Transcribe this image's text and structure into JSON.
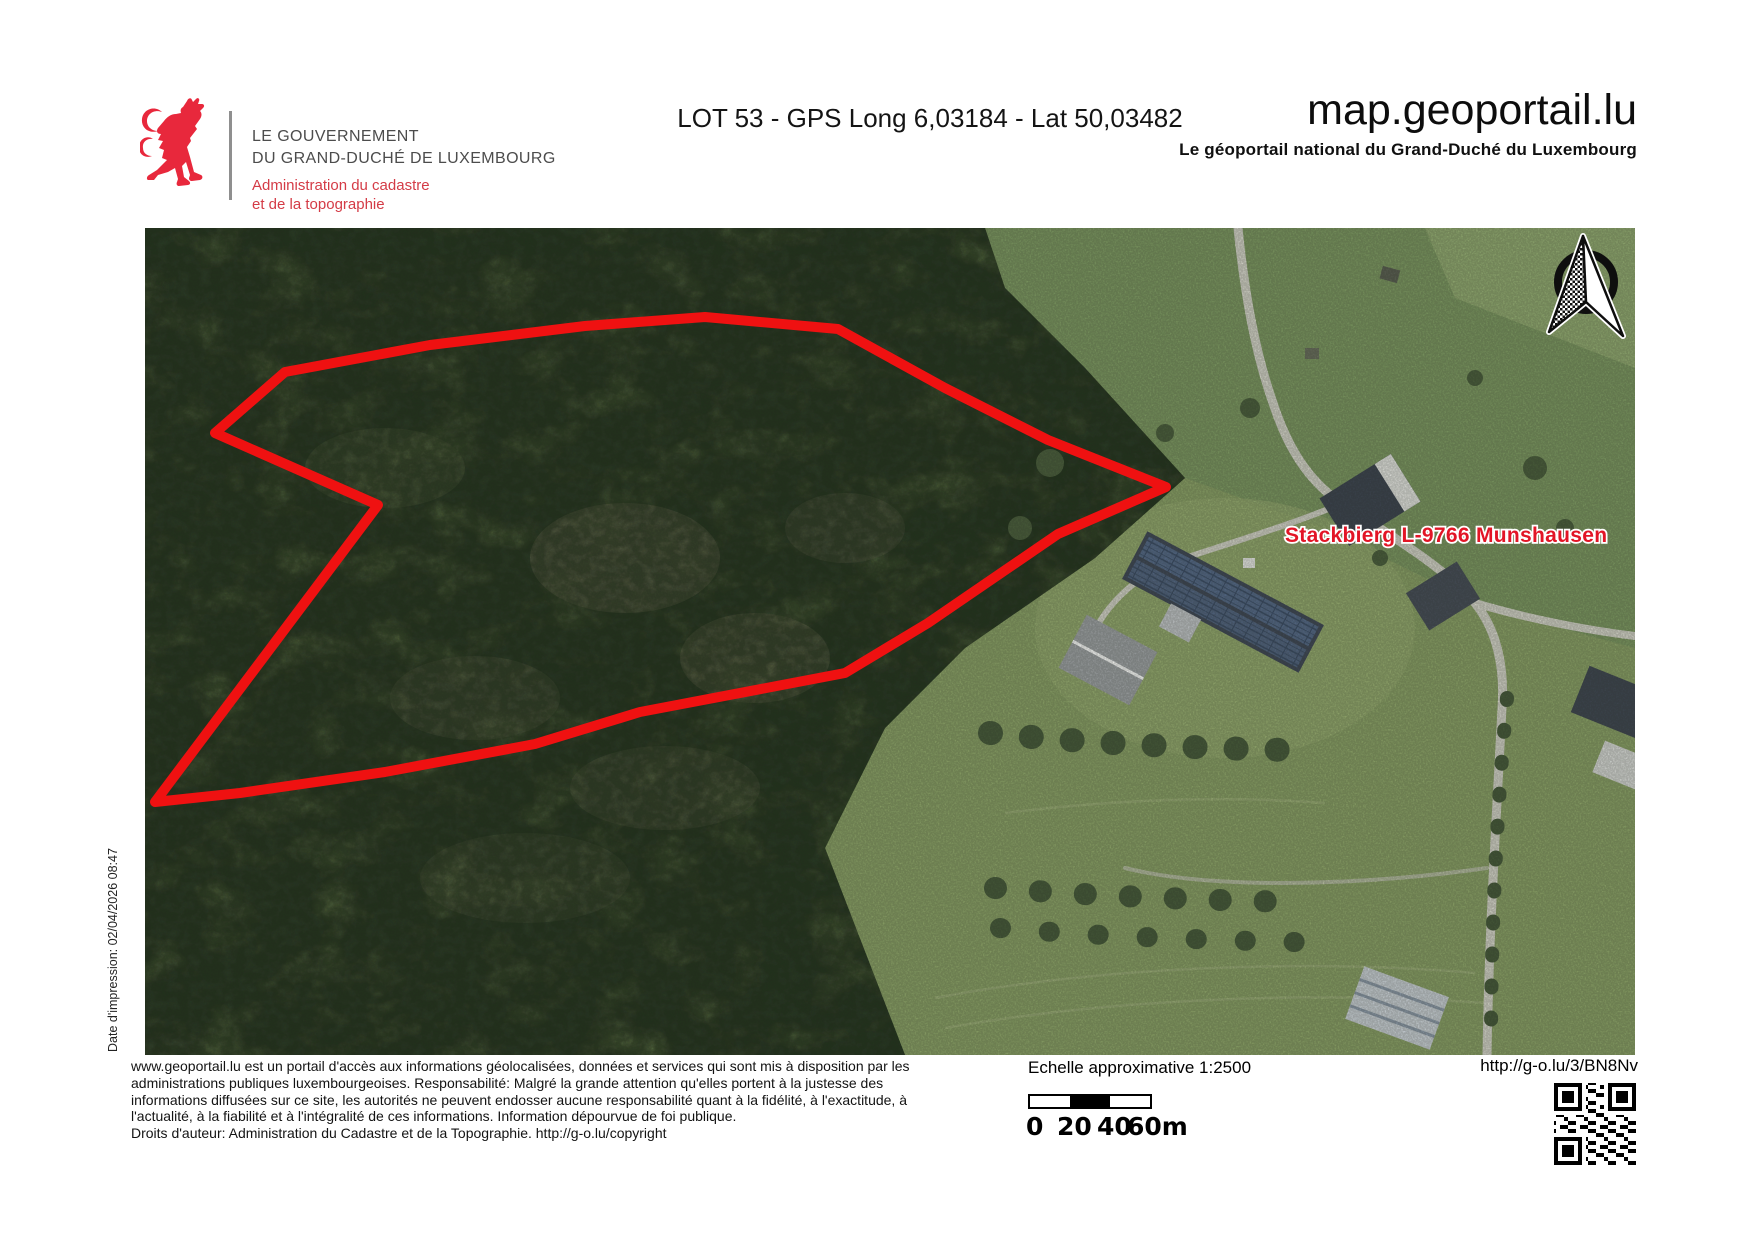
{
  "header": {
    "government_line1": "LE GOUVERNEMENT",
    "government_line2": "DU GRAND-DUCHÉ DE LUXEMBOURG",
    "administration_line1": "Administration du cadastre",
    "administration_line2": "et de la topographie",
    "document_title": "LOT 53 - GPS Long 6,03184 - Lat 50,03482",
    "site_name": "map.geoportail.lu",
    "site_tagline": "Le géoportail national du Grand-Duché du Luxembourg",
    "brand_red": "#e8283c"
  },
  "map": {
    "parcel_label": "Stackbierg L-9766 Munshausen",
    "label_color": "#e21526",
    "parcel_color": "#ef1111",
    "parcel_outline_points": "140,144 285,117 440,98 560,89 693,101 800,160 903,212 1021,259 913,306 783,395 700,445 495,484 390,516 240,544 95,565 10,574 233,277 70,205",
    "print_date_note": "Date d'impression: 02/04/2026 08:47",
    "north_arrow_icon": "north-arrow"
  },
  "footer": {
    "disclaimer_lines": [
      "www.geoportail.lu est un portail d'accès aux informations géolocalisées, données et services qui sont mis à disposition par les",
      "administrations publiques luxembourgeoises. Responsabilité: Malgré la grande attention qu'elles portent à la justesse des",
      "informations diffusées sur ce site, les autorités ne peuvent endosser aucune responsabilité quant à la fidélité, à l'exactitude, à",
      "l'actualité, à la fiabilité et à l'intégralité de ces informations. Information dépourvue de foi publique.",
      "Droits d'auteur: Administration du Cadastre et de la Topographie. http://g-o.lu/copyright"
    ],
    "scale_label": "Echelle approximative 1:2500",
    "scale_ticks": [
      "0",
      "20",
      "40",
      "60m"
    ],
    "short_url": "http://g-o.lu/3/BN8Nv"
  }
}
